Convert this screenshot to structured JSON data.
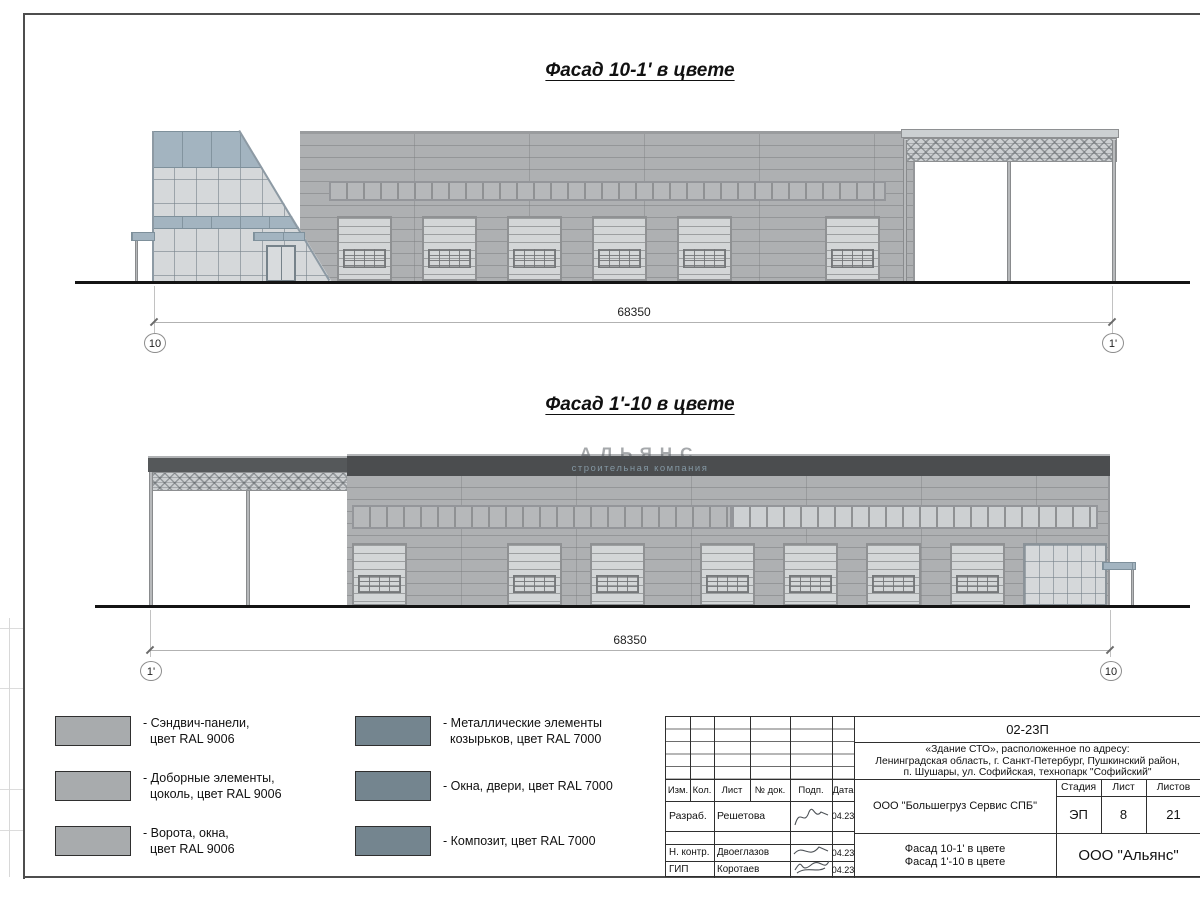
{
  "drawing": {
    "facade1": {
      "title": "Фасад 10-1' в цвете",
      "dim": "68350",
      "axis_left": "10",
      "axis_right": "1'"
    },
    "facade2": {
      "title": "Фасад 1'-10 в цвете",
      "dim": "68350",
      "axis_left": "1'",
      "axis_right": "10",
      "watermark_logo": "АЛЬЯНС",
      "watermark_subtitle": "строительная компания"
    }
  },
  "legend": {
    "items": [
      {
        "lines": [
          "- Сэндвич-панели,",
          "цвет RAL 9006"
        ],
        "color": "#a8abad"
      },
      {
        "lines": [
          "- Доборные элементы,",
          "цоколь, цвет RAL 9006"
        ],
        "color": "#a8abad"
      },
      {
        "lines": [
          "- Ворота, окна,",
          "цвет RAL 9006"
        ],
        "color": "#a8abad"
      },
      {
        "lines": [
          "- Металлические элементы",
          "козырьков, цвет RAL 7000"
        ],
        "color": "#74858f"
      },
      {
        "lines": [
          "- Окна, двери, цвет RAL 7000"
        ],
        "color": "#74858f"
      },
      {
        "lines": [
          "- Композит, цвет RAL 7000"
        ],
        "color": "#74858f"
      }
    ]
  },
  "titleblock": {
    "doc_number": "02-23П",
    "project_address_lines": [
      "«Здание СТО», расположенное по адресу:",
      "Ленинградская область, г. Санкт-Петербург, Пушкинский район,",
      "п. Шушары, ул. Софийская, технопарк \"Софийский\""
    ],
    "columns": [
      "Изм.",
      "Кол.",
      "Лист",
      "№ док.",
      "Подп.",
      "Дата"
    ],
    "signers": [
      {
        "role": "Разраб.",
        "name": "Решетова",
        "date": "04.23"
      },
      {
        "role": "Н. контр.",
        "name": "Двоеглазов",
        "date": "04.23"
      },
      {
        "role": "ГИП",
        "name": "Коротаев",
        "date": "04.23"
      }
    ],
    "company": "ООО \"Большегруз Сервис СПБ\"",
    "stage_label": "Стадия",
    "sheet_label": "Лист",
    "sheets_label": "Листов",
    "stage_value": "ЭП",
    "sheet_value": "8",
    "sheets_value": "21",
    "sheet_title_lines": [
      "Фасад 10-1' в цвете",
      "Фасад 1'-10 в цвете"
    ],
    "org": "ООО \"Альянс\""
  },
  "colors": {
    "ral9006": "#a8abad",
    "ral7000": "#74858f",
    "accent_blue": "#a3b4c0",
    "wall_gray": "#aeb0b2",
    "parapet_dark": "#4b4d4f"
  }
}
